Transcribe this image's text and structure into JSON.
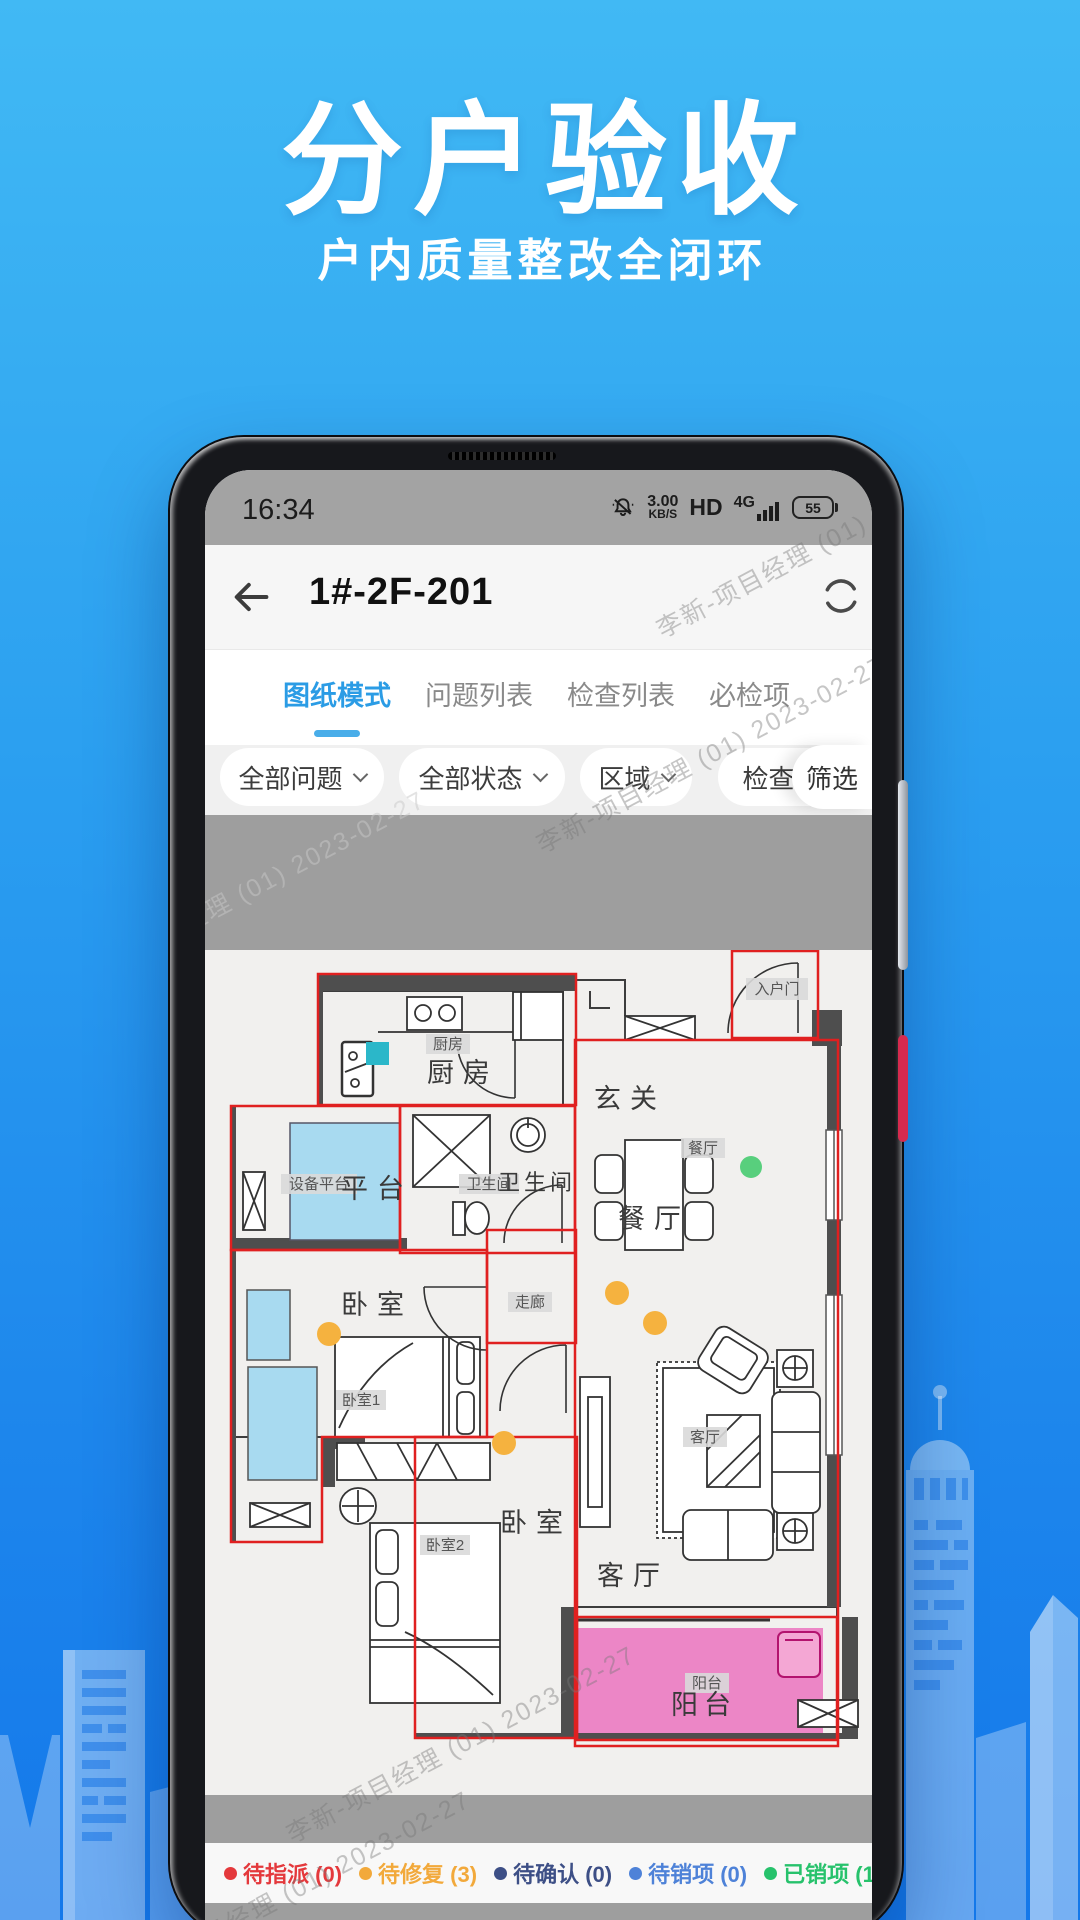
{
  "hero": {
    "title": "分户验收",
    "subtitle": "户内质量整改全闭环"
  },
  "status_bar": {
    "time": "16:34",
    "speed": "3.00",
    "speed_unit": "KB/S",
    "hd": "HD",
    "network": "4G",
    "battery": "55"
  },
  "nav": {
    "title": "1#-2F-201"
  },
  "tabs": [
    {
      "label": "图纸模式"
    },
    {
      "label": "问题列表"
    },
    {
      "label": "检查列表"
    },
    {
      "label": "必检项"
    }
  ],
  "filters": {
    "chips": [
      {
        "label": "全部问题"
      },
      {
        "label": "全部状态"
      },
      {
        "label": "区域"
      },
      {
        "label": "检查项"
      }
    ],
    "filter_label": "筛选"
  },
  "floorplan": {
    "rooms": {
      "kitchen": "厨房",
      "foyer": "玄关",
      "dining": "餐厅",
      "platform": "平台",
      "bathroom": "卫生间",
      "bedroom1": "卧室",
      "bedroom2": "卧室",
      "living": "客厅",
      "balcony": "阳台"
    },
    "tags": {
      "kitchen": "厨房",
      "entry_door": "入户门",
      "dining": "餐厅",
      "equipment_platform": "设备平台",
      "bathroom": "卫生间",
      "corridor": "走廊",
      "bedroom1": "卧室1",
      "bedroom2": "卧室2",
      "living": "客厅",
      "balcony": "阳台"
    },
    "colors": {
      "zone_outline": "#E02020",
      "issue_pending_fix": "#F5B23F",
      "issue_closed": "#58CF7D",
      "check_marker": "#2BB7C9",
      "balcony_fill": "#EC86C6",
      "platform_fill": "#A8DAF0"
    }
  },
  "legend": [
    {
      "label": "待指派",
      "count": "(0)",
      "color": "#E4393C"
    },
    {
      "label": "待修复",
      "count": "(3)",
      "color": "#F2A93B"
    },
    {
      "label": "待确认",
      "count": "(0)",
      "color": "#3D4F86"
    },
    {
      "label": "待销项",
      "count": "(0)",
      "color": "#4E82D8"
    },
    {
      "label": "已销项",
      "count": "(1)",
      "color": "#27C26C"
    },
    {
      "label": "记",
      "count": "",
      "color": "#39AEE4"
    }
  ],
  "watermark": "李新-项目经理 (01) 2023-02-27"
}
